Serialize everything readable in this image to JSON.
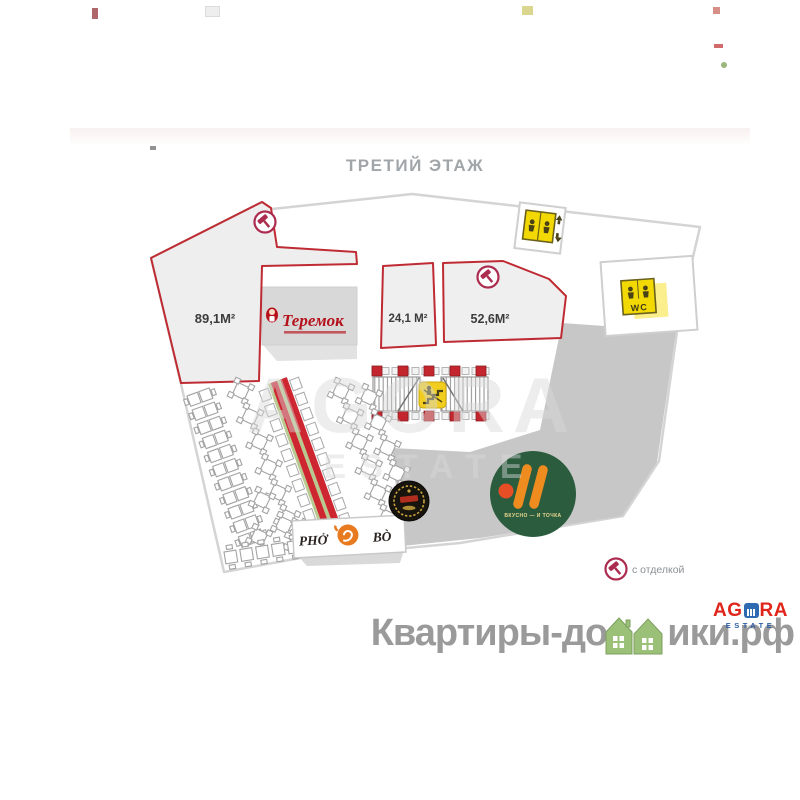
{
  "title": "ТРЕТИЙ ЭТАЖ",
  "plan": {
    "units": [
      {
        "id": "unit-89",
        "area": "89,1М²",
        "finished": true
      },
      {
        "id": "unit-24",
        "area": "24,1 М²",
        "finished": false
      },
      {
        "id": "unit-52",
        "area": "52,6М²",
        "finished": true
      }
    ],
    "tenants": {
      "teremok": {
        "name": "Теремок"
      },
      "pho_bo": {
        "left": "PHỞ",
        "right": "BÒ"
      },
      "vkusno_i_tochka": {
        "name": "ВКУСНО — И ТОЧКА"
      }
    },
    "facilities": {
      "wc": "WC"
    },
    "legend": {
      "finishing": "с отделкой"
    }
  },
  "watermarks": {
    "center_brand": "AGORA",
    "center_sub": "ESTATE",
    "footer_site_prefix": "Квартиры-до",
    "footer_site_suffix": "ики.рф",
    "footer_agora_left": "AG",
    "footer_agora_right": "RA",
    "footer_agora_sub": "ESTATE"
  },
  "colors": {
    "unit_outline": "#bf2b33",
    "icon_yellow": "#f2d903",
    "vkusno_green": "#2b5c3e",
    "vkusno_orange": "#ef8c1f",
    "band_red": "#ce2631",
    "footer_green": "#9bc178",
    "agora_red": "#e0251b",
    "agora_blue": "#2d6ab1"
  }
}
